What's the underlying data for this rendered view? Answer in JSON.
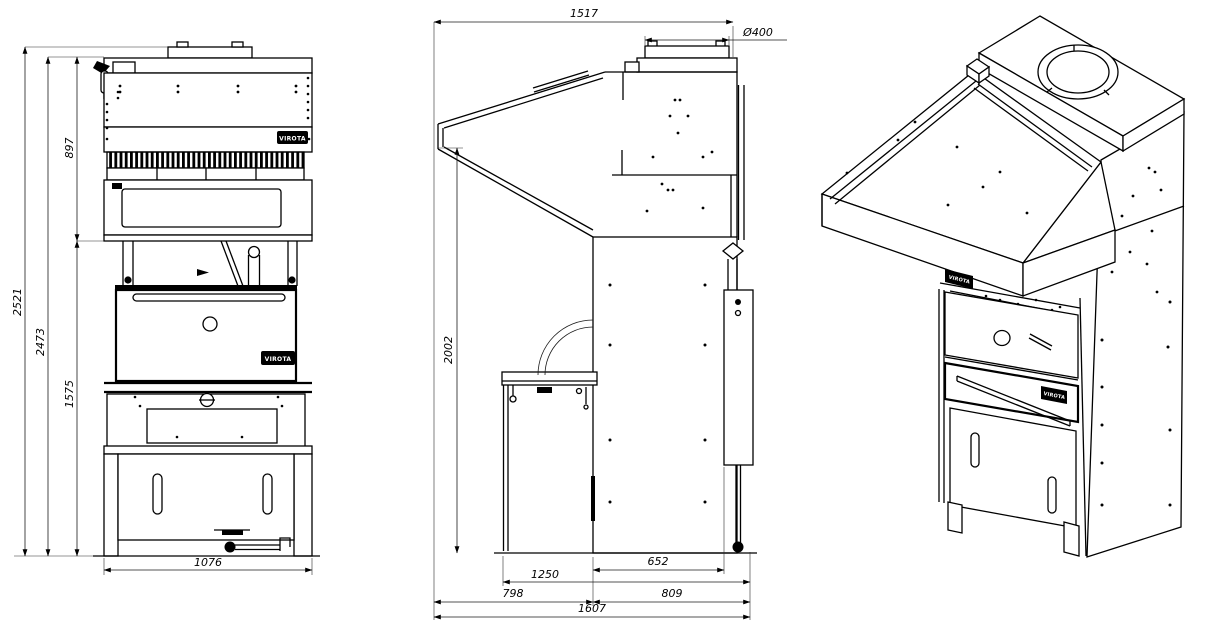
{
  "drawing": {
    "brand": "VIROTA",
    "front_view": {
      "dims": {
        "overall_height": "2521",
        "frame_height": "2473",
        "hood_height": "897",
        "base_height": "1575",
        "width": "1076"
      }
    },
    "side_view": {
      "dims": {
        "top_width": "1517",
        "flue_diameter": "Ø400",
        "height": "2002",
        "body_depth": "652",
        "mid_depth": "1250",
        "front_overhang": "798",
        "rear_depth": "809",
        "overall_depth": "1607"
      }
    }
  }
}
